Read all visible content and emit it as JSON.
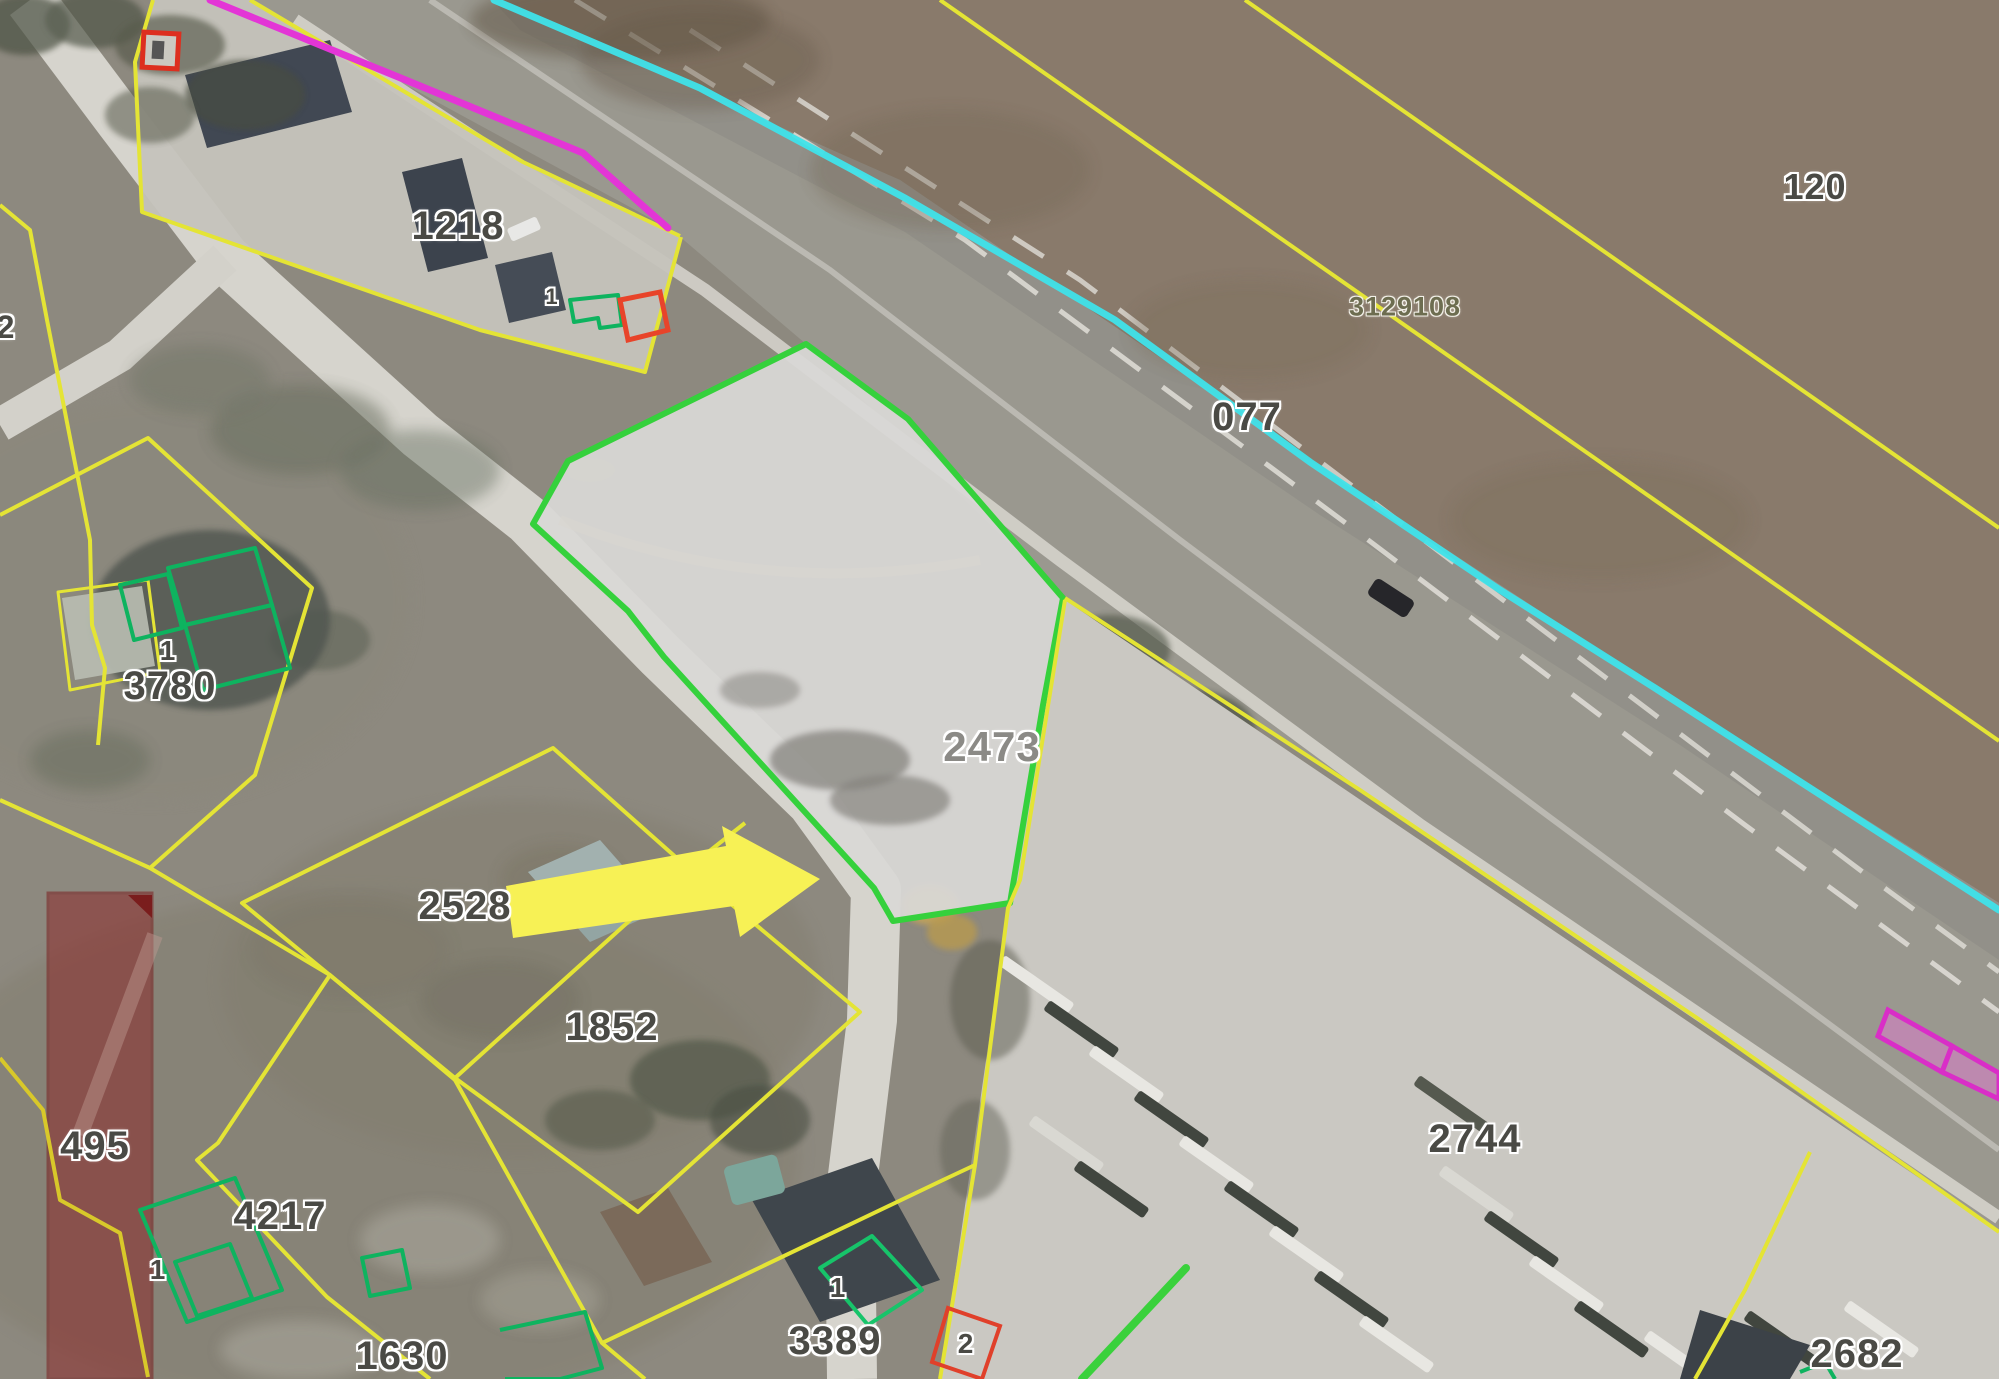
{
  "map": {
    "type": "cadastral-satellite-view",
    "highlighted_parcel": {
      "id": "2473",
      "outline_color": "#35d13c",
      "note": "parcel indicated by yellow arrow"
    },
    "colors": {
      "parcel_boundary_yellow": "#e4e435",
      "highlight_green": "#35d13c",
      "building_outline_green": "#0eb35f",
      "road_edge_cyan": "#3fe3ea",
      "overlay_magenta": "#e335d6",
      "marker_red": "#dd2f1f",
      "restricted_building_fill": "#8c2a2a",
      "pointer_arrow_yellow": "#f7f155"
    },
    "parcel_labels": [
      {
        "text": "1218",
        "x": 458,
        "y": 226,
        "size": 40
      },
      {
        "text": "120",
        "x": 1815,
        "y": 187,
        "size": 36
      },
      {
        "text": "3129108",
        "x": 1405,
        "y": 307,
        "size": 27,
        "variant": "olive"
      },
      {
        "text": "077",
        "x": 1247,
        "y": 417,
        "size": 40
      },
      {
        "text": "2",
        "x": 6,
        "y": 327,
        "size": 32
      },
      {
        "text": "1",
        "x": 552,
        "y": 297,
        "size": 22
      },
      {
        "text": "1",
        "x": 168,
        "y": 651,
        "size": 28
      },
      {
        "text": "3780",
        "x": 170,
        "y": 686,
        "size": 40
      },
      {
        "text": "2473",
        "x": 992,
        "y": 747,
        "size": 42,
        "variant": "light"
      },
      {
        "text": "2528",
        "x": 465,
        "y": 906,
        "size": 40
      },
      {
        "text": "1852",
        "x": 612,
        "y": 1027,
        "size": 40
      },
      {
        "text": "495",
        "x": 95,
        "y": 1146,
        "size": 40
      },
      {
        "text": "4217",
        "x": 280,
        "y": 1216,
        "size": 40
      },
      {
        "text": "1",
        "x": 158,
        "y": 1270,
        "size": 28
      },
      {
        "text": "1630",
        "x": 402,
        "y": 1356,
        "size": 40
      },
      {
        "text": "1",
        "x": 838,
        "y": 1288,
        "size": 28
      },
      {
        "text": "3389",
        "x": 835,
        "y": 1341,
        "size": 40
      },
      {
        "text": "2",
        "x": 966,
        "y": 1344,
        "size": 28
      },
      {
        "text": "2744",
        "x": 1475,
        "y": 1139,
        "size": 40
      },
      {
        "text": "2682",
        "x": 1857,
        "y": 1354,
        "size": 40
      }
    ]
  }
}
